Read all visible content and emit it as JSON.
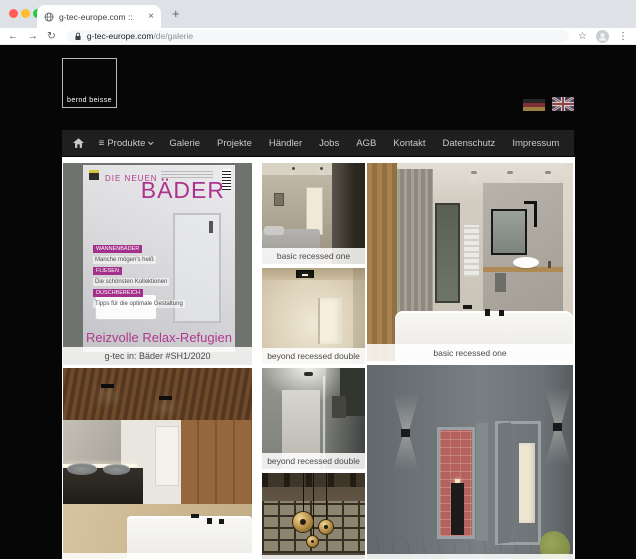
{
  "browser": {
    "tab_title": "g-tec-europe.com ::",
    "url_domain": "g-tec-europe.com",
    "url_path": "/de/galerie"
  },
  "icons": {
    "close": "×",
    "new_tab": "+",
    "back": "←",
    "forward": "→",
    "reload": "↻",
    "star": "☆",
    "kebab": "⋮",
    "hamburger": "≡"
  },
  "header": {
    "logo_text": "bernd beisse",
    "languages": [
      "german-flag",
      "uk-flag"
    ]
  },
  "nav": {
    "items": [
      "Produkte",
      "Galerie",
      "Projekte",
      "Händler",
      "Jobs",
      "AGB",
      "Kontakt",
      "Datenschutz",
      "Impressum"
    ]
  },
  "magazine": {
    "kicker": "DIE NEUEN",
    "title": "BÄDER",
    "topics": [
      {
        "label": "WANNENBÄDER",
        "text": "Manche mögen's heiß"
      },
      {
        "label": "FLIESEN",
        "text": "Die schönsten Kollektionen"
      },
      {
        "label": "DUSCHBEREICH",
        "text": "Tipps für die optimale Gestaltung"
      }
    ],
    "headline": "Reizvolle Relax-Refugien"
  },
  "gallery": {
    "tiles": [
      {
        "name": "magazine-cover",
        "caption": "g-tec in: Bäder #SH1/2020"
      },
      {
        "name": "bedroom-recessed",
        "caption": "basic recessed one"
      },
      {
        "name": "corridor-beige",
        "caption": "beyond recessed double"
      },
      {
        "name": "bathroom-tub",
        "caption": "basic recessed one"
      },
      {
        "name": "bathroom-wood-ceiling",
        "caption": ""
      },
      {
        "name": "shower-grey",
        "caption": "beyond recessed double"
      },
      {
        "name": "atrium-pendants",
        "caption": ""
      },
      {
        "name": "corridor-pink",
        "caption": ""
      }
    ]
  },
  "colors": {
    "accent_magenta": "#ad3390",
    "nav_bg": "#1f1f1f",
    "page_bg": "#060606"
  }
}
